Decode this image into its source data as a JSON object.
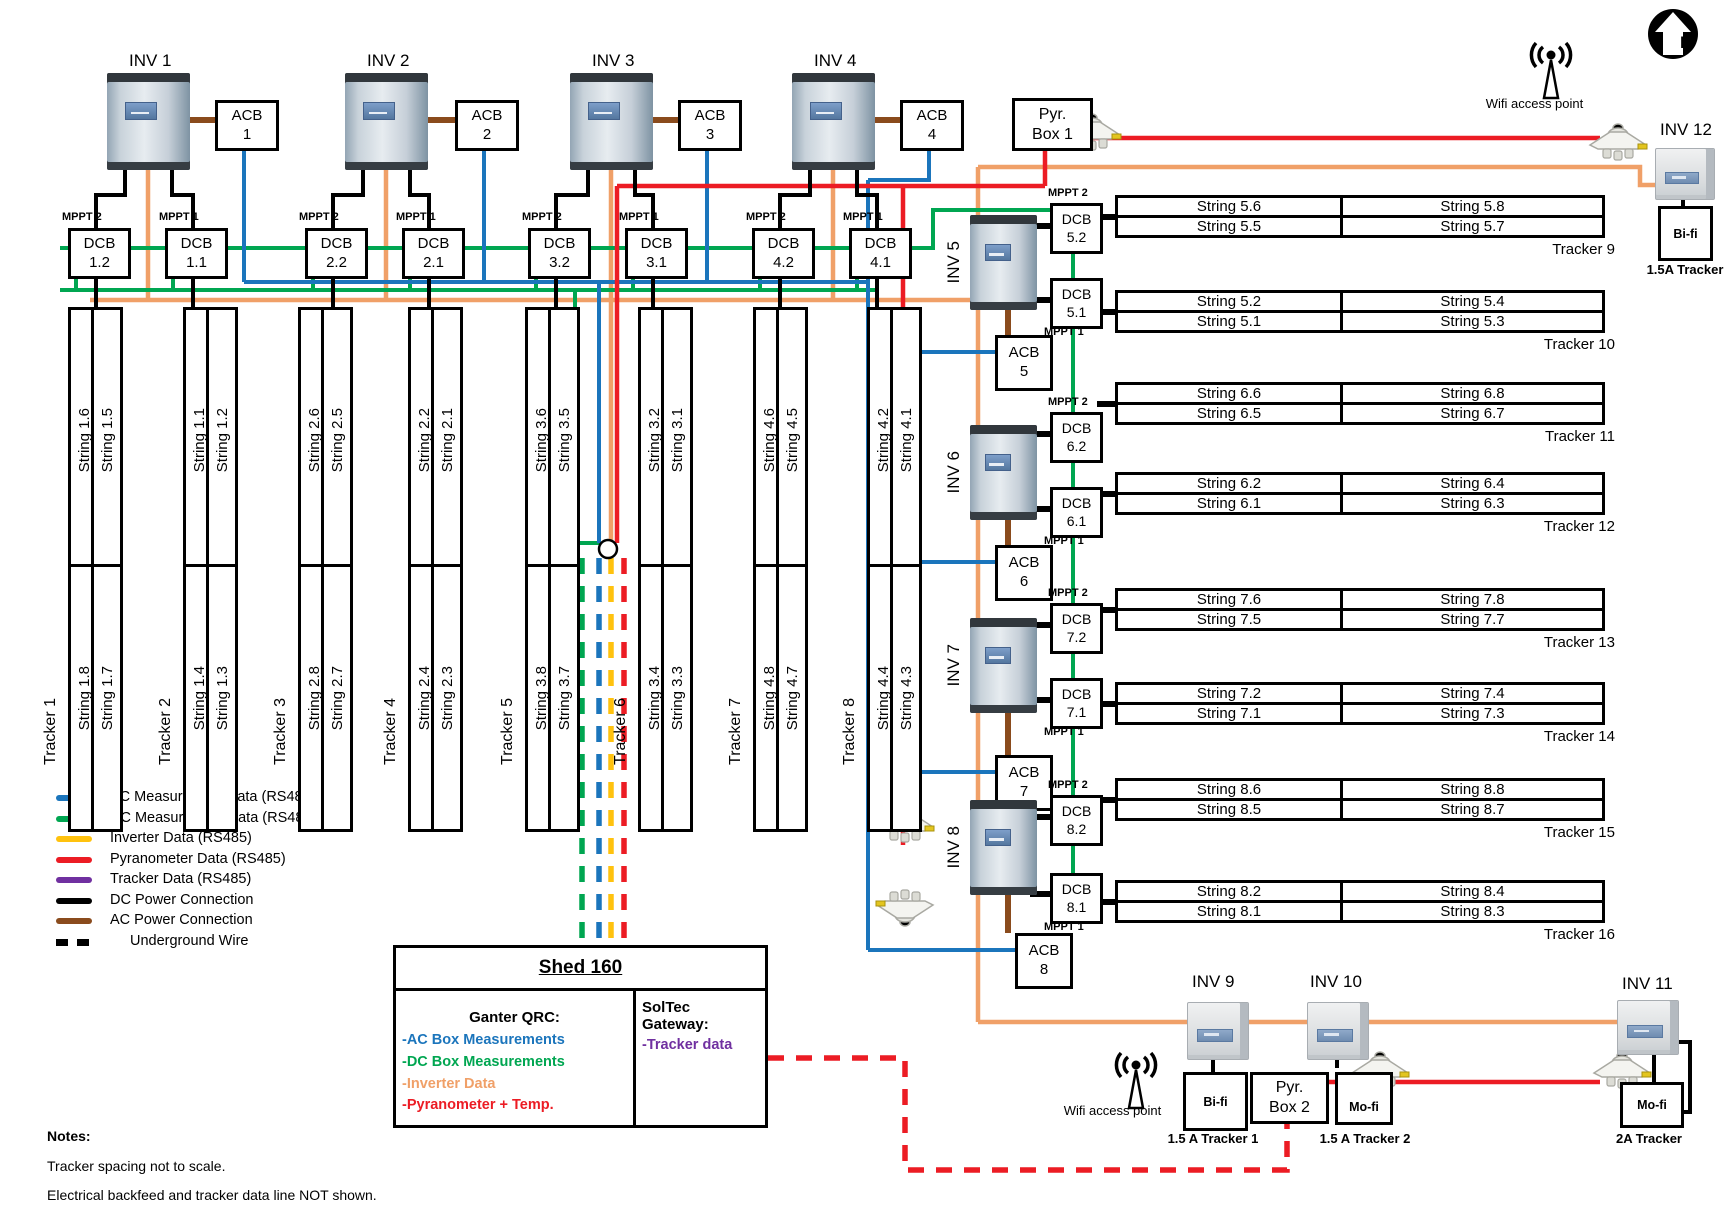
{
  "colors": {
    "ac_data": "#1B75BC",
    "dc_data": "#00A651",
    "inverter_data": "#FFC20E",
    "inverter_wire": "#F0A068",
    "pyranometer_data": "#EC1C24",
    "tracker_data": "#7030A0",
    "dc_power": "#000000",
    "ac_power": "#8A4B1D"
  },
  "top_units": [
    {
      "inv": "INV 1",
      "acb": [
        "ACB",
        "1"
      ],
      "dcbs": [
        {
          "mppt": "MPPT 2",
          "label": [
            "DCB",
            "1.2"
          ]
        },
        {
          "mppt": "MPPT 1",
          "label": [
            "DCB",
            "1.1"
          ]
        }
      ]
    },
    {
      "inv": "INV 2",
      "acb": [
        "ACB",
        "2"
      ],
      "dcbs": [
        {
          "mppt": "MPPT 2",
          "label": [
            "DCB",
            "2.2"
          ]
        },
        {
          "mppt": "MPPT 1",
          "label": [
            "DCB",
            "2.1"
          ]
        }
      ]
    },
    {
      "inv": "INV 3",
      "acb": [
        "ACB",
        "3"
      ],
      "dcbs": [
        {
          "mppt": "MPPT 2",
          "label": [
            "DCB",
            "3.2"
          ]
        },
        {
          "mppt": "MPPT 1",
          "label": [
            "DCB",
            "3.1"
          ]
        }
      ]
    },
    {
      "inv": "INV 4",
      "acb": [
        "ACB",
        "4"
      ],
      "dcbs": [
        {
          "mppt": "MPPT 2",
          "label": [
            "DCB",
            "4.2"
          ]
        },
        {
          "mppt": "MPPT 1",
          "label": [
            "DCB",
            "4.1"
          ]
        }
      ]
    }
  ],
  "pyr_box1": [
    "Pyr.",
    "Box 1"
  ],
  "trackers": [
    {
      "label": "Tracker 1",
      "top": [
        "String 1.6",
        "String 1.5"
      ],
      "bottom": [
        "String 1.8",
        "String 1.7"
      ]
    },
    {
      "label": "Tracker 2",
      "top": [
        "String 1.1",
        "String 1.2"
      ],
      "bottom": [
        "String 1.4",
        "String 1.3"
      ]
    },
    {
      "label": "Tracker 3",
      "top": [
        "String 2.6",
        "String 2.5"
      ],
      "bottom": [
        "String 2.8",
        "String 2.7"
      ]
    },
    {
      "label": "Tracker 4",
      "top": [
        "String 2.2",
        "String 2.1"
      ],
      "bottom": [
        "String 2.4",
        "String 2.3"
      ]
    },
    {
      "label": "Tracker 5",
      "top": [
        "String 3.6",
        "String 3.5"
      ],
      "bottom": [
        "String 3.8",
        "String 3.7"
      ]
    },
    {
      "label": "Tracker 6",
      "top": [
        "String 3.2",
        "String 3.1"
      ],
      "bottom": [
        "String 3.4",
        "String 3.3"
      ]
    },
    {
      "label": "Tracker 7",
      "top": [
        "String 4.6",
        "String 4.5"
      ],
      "bottom": [
        "String 4.8",
        "String 4.7"
      ]
    },
    {
      "label": "Tracker 8",
      "top": [
        "String 4.2",
        "String 4.1"
      ],
      "bottom": [
        "String 4.4",
        "String 4.3"
      ]
    }
  ],
  "right_units": [
    {
      "inv": "INV 5",
      "acb": [
        "ACB",
        "5"
      ],
      "dcb_top": {
        "mppt": "MPPT 2",
        "label": [
          "DCB",
          "5.2"
        ]
      },
      "dcb_bottom": {
        "mppt": "MPPT 1",
        "label": [
          "DCB",
          "5.1"
        ]
      },
      "tables": [
        {
          "rows": [
            [
              "String 5.6",
              "String 5.8"
            ],
            [
              "String 5.5",
              "String 5.7"
            ]
          ],
          "caption": "Tracker 9"
        },
        {
          "rows": [
            [
              "String 5.2",
              "String 5.4"
            ],
            [
              "String 5.1",
              "String 5.3"
            ]
          ],
          "caption": "Tracker 10"
        }
      ]
    },
    {
      "inv": "INV 6",
      "acb": [
        "ACB",
        "6"
      ],
      "dcb_top": {
        "mppt": "MPPT 2",
        "label": [
          "DCB",
          "6.2"
        ]
      },
      "dcb_bottom": {
        "mppt": "MPPT 1",
        "label": [
          "DCB",
          "6.1"
        ]
      },
      "tables": [
        {
          "rows": [
            [
              "String 6.6",
              "String 6.8"
            ],
            [
              "String 6.5",
              "String 6.7"
            ]
          ],
          "caption": "Tracker 11"
        },
        {
          "rows": [
            [
              "String 6.2",
              "String 6.4"
            ],
            [
              "String 6.1",
              "String 6.3"
            ]
          ],
          "caption": "Tracker 12"
        }
      ]
    },
    {
      "inv": "INV 7",
      "acb": [
        "ACB",
        "7"
      ],
      "dcb_top": {
        "mppt": "MPPT 2",
        "label": [
          "DCB",
          "7.2"
        ]
      },
      "dcb_bottom": {
        "mppt": "MPPT 1",
        "label": [
          "DCB",
          "7.1"
        ]
      },
      "tables": [
        {
          "rows": [
            [
              "String 7.6",
              "String 7.8"
            ],
            [
              "String 7.5",
              "String 7.7"
            ]
          ],
          "caption": "Tracker 13"
        },
        {
          "rows": [
            [
              "String 7.2",
              "String 7.4"
            ],
            [
              "String 7.1",
              "String 7.3"
            ]
          ],
          "caption": "Tracker 14"
        }
      ]
    },
    {
      "inv": "INV 8",
      "acb": [
        "ACB",
        "8"
      ],
      "dcb_top": {
        "mppt": "MPPT 2",
        "label": [
          "DCB",
          "8.2"
        ]
      },
      "dcb_bottom": {
        "mppt": "MPPT 1",
        "label": [
          "DCB",
          "8.1"
        ]
      },
      "tables": [
        {
          "rows": [
            [
              "String 8.6",
              "String 8.8"
            ],
            [
              "String 8.5",
              "String 8.7"
            ]
          ],
          "caption": "Tracker 15"
        },
        {
          "rows": [
            [
              "String 8.2",
              "String 8.4"
            ],
            [
              "String 8.1",
              "String 8.3"
            ]
          ],
          "caption": "Tracker 16"
        }
      ]
    }
  ],
  "top_right": {
    "wifi_label": "Wifi access point",
    "north": "N",
    "inv12": {
      "label": "INV 12",
      "box": "Bi-fi",
      "caption": "1.5A Tracker"
    }
  },
  "bottom": {
    "wifi_label": "Wifi access point",
    "pyr_box2": [
      "Pyr.",
      "Box 2"
    ],
    "units": [
      {
        "label": "INV 9",
        "box": "Bi-fi",
        "caption": "1.5 A Tracker 1"
      },
      {
        "label": "INV 10",
        "box": "Mo-fi",
        "caption": "1.5 A Tracker 2"
      },
      {
        "label": "INV 11",
        "box": "Mo-fi",
        "caption": "2A Tracker"
      }
    ]
  },
  "legend": {
    "items": [
      {
        "label": "AC Measurement Data (RS485)",
        "color": "#1B75BC",
        "style": "solid"
      },
      {
        "label": "DC Measurement Data (RS485)",
        "color": "#00A651",
        "style": "solid"
      },
      {
        "label": "Inverter Data (RS485)",
        "color": "#FFC20E",
        "style": "solid"
      },
      {
        "label": "Pyranometer Data (RS485)",
        "color": "#EC1C24",
        "style": "solid"
      },
      {
        "label": "Tracker Data (RS485)",
        "color": "#7030A0",
        "style": "solid"
      },
      {
        "label": "DC Power Connection",
        "color": "#000000",
        "style": "solid"
      },
      {
        "label": "AC Power Connection",
        "color": "#8A4B1D",
        "style": "solid"
      },
      {
        "label": "Underground Wire",
        "color": "#000000",
        "style": "dashed"
      }
    ]
  },
  "shed": {
    "title": "Shed 160",
    "left_title": "Ganter QRC:",
    "left_items": [
      {
        "text": "-AC Box Measurements",
        "color": "#1B75BC"
      },
      {
        "text": "-DC Box Measurements",
        "color": "#00A651"
      },
      {
        "text": "-Inverter Data",
        "color": "#F0A068"
      },
      {
        "text": "-Pyranometer + Temp.",
        "color": "#EC1C24"
      }
    ],
    "right_title": "SolTec Gateway:",
    "right_items": [
      {
        "text": "-Tracker data",
        "color": "#7030A0"
      }
    ]
  },
  "notes": {
    "title": "Notes:",
    "lines": [
      "Tracker spacing not to scale.",
      "Electrical backfeed and tracker data line NOT shown."
    ]
  }
}
